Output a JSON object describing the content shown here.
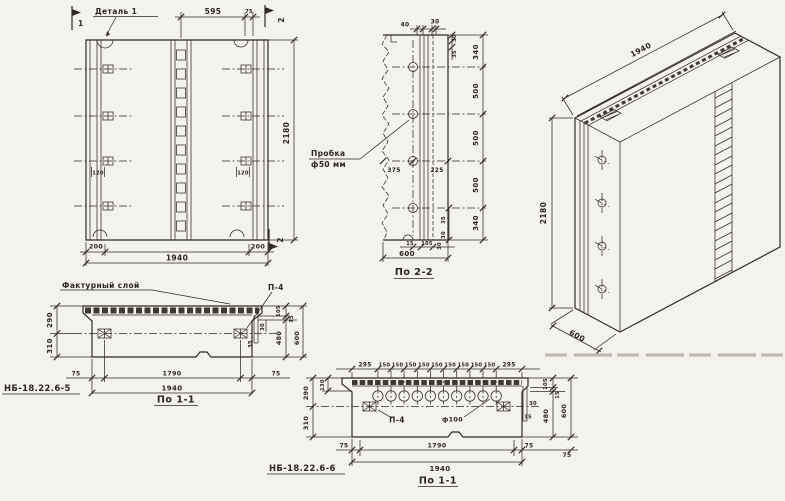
{
  "front_view": {
    "detail_callout": "Деталь 1",
    "flag_1": "1",
    "flag_2_top": "2",
    "flag_2_bottom": "2",
    "dim_595": "595",
    "dim_75": "75",
    "dim_120_left": "120",
    "dim_120_right": "120",
    "dim_200_left": "200",
    "dim_200_right": "200",
    "dim_1940": "1940",
    "dim_2180": "2180"
  },
  "section_2_2": {
    "title": "По 2-2",
    "plug_label_line1": "Пробка",
    "plug_label_line2": "ф50 мм",
    "dim_top_40": "40",
    "dim_top_30": "30",
    "dim_375": "375",
    "dim_225": "225",
    "right_dims": [
      "30",
      "35",
      "340",
      "500",
      "500",
      "500",
      "340",
      "35",
      "30"
    ],
    "dim_15": "15",
    "dim_105": "105",
    "dim_30_bottom": "30",
    "dim_600": "600"
  },
  "iso_view": {
    "dim_1940": "1940",
    "dim_2180": "2180",
    "dim_600": "600"
  },
  "section_1_1_left": {
    "mark": "НБ-18.22.6-5",
    "title": "По 1-1",
    "texture_label": "Фактурный слой",
    "anchor_label": "П-4",
    "dim_290": "290",
    "dim_310": "310",
    "dim_30": "30",
    "dim_35": "35",
    "dim_105": "105",
    "dim_15": "15",
    "dim_480": "480",
    "dim_600": "600",
    "dim_75_left": "75",
    "dim_1790": "1790",
    "dim_75_right": "75",
    "dim_1940": "1940"
  },
  "section_1_1_right": {
    "mark": "НБ-18.22.6-6",
    "title": "По 1-1",
    "anchor_label": "П-4",
    "hole_label": "ф100",
    "top_dims": [
      "295",
      "150",
      "150",
      "150",
      "150",
      "150",
      "150",
      "150",
      "150",
      "150",
      "295"
    ],
    "dim_290": "290",
    "dim_130": "130",
    "dim_310": "310",
    "dim_30": "30",
    "dim_35": "35",
    "dim_105": "105",
    "dim_15": "15",
    "dim_480": "480",
    "dim_600": "600",
    "dim_75_left": "75",
    "dim_1790": "1790",
    "dim_75_right": "75",
    "dim_75_far": "75",
    "dim_1940": "1940"
  }
}
